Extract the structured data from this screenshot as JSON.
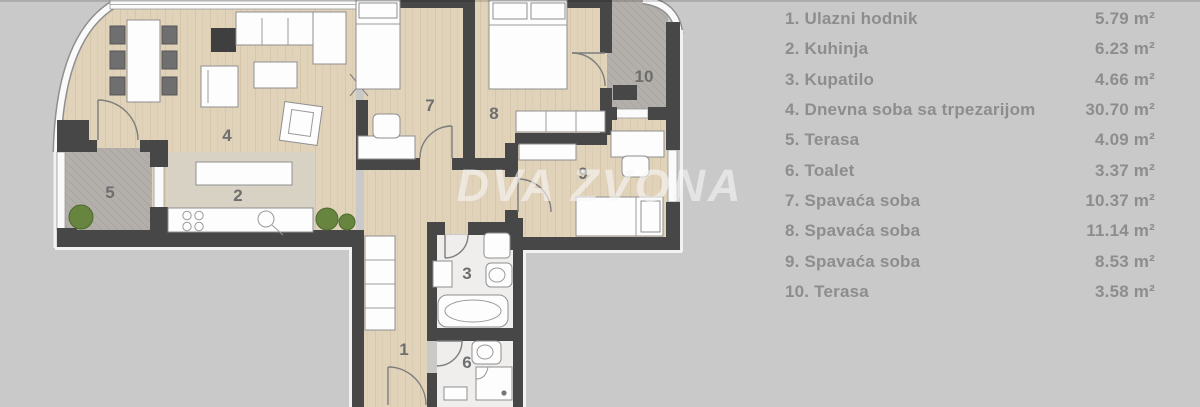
{
  "watermark": "DVA ZVONA",
  "legend": {
    "rows": [
      {
        "label": "1. Ulazni hodnik",
        "area": "5.79 m²"
      },
      {
        "label": "2. Kuhinja",
        "area": "6.23 m²"
      },
      {
        "label": "3. Kupatilo",
        "area": "4.66 m²"
      },
      {
        "label": "4. Dnevna soba sa trpezarijom",
        "area": "30.70 m²"
      },
      {
        "label": "5. Terasa",
        "area": "4.09 m²"
      },
      {
        "label": "6. Toalet",
        "area": "3.37 m²"
      },
      {
        "label": "7. Spavaća soba",
        "area": "10.37 m²"
      },
      {
        "label": "8. Spavaća soba",
        "area": "11.14 m²"
      },
      {
        "label": "9. Spavaća soba",
        "area": "8.53 m²"
      },
      {
        "label": "10. Terasa",
        "area": "3.58 m²"
      }
    ]
  },
  "plan": {
    "room_labels": [
      "1",
      "2",
      "3",
      "4",
      "5",
      "6",
      "7",
      "8",
      "9",
      "10"
    ]
  },
  "colors": {
    "bg": "#c9c9c9",
    "wall": "#474747",
    "wood": "#e1d3ba",
    "wood-line": "#d2c2a4",
    "kitchen-floor": "#d8d2c4",
    "terrace": "#b3afab",
    "tile": "#efeeec",
    "legend-text": "#8d8d8d",
    "plant": "#68853f",
    "watermark": "rgba(247,247,247,0.6)"
  }
}
